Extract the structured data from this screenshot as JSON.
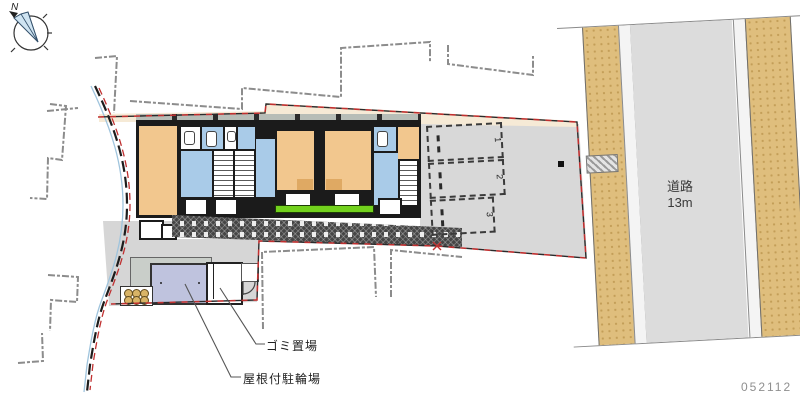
{
  "drawing": {
    "type": "site-and-floor-plan",
    "plan_number": "052112"
  },
  "compass": {
    "north_label": "N"
  },
  "road": {
    "label": "道路",
    "width_label": "13m"
  },
  "annotations": {
    "garbage_label": "ゴミ置場",
    "bike_shed_label": "屋根付駐輪場"
  },
  "parking": {
    "spaces": [
      {
        "label": "1"
      },
      {
        "label": "2"
      },
      {
        "label": "3"
      }
    ]
  },
  "colors": {
    "room_orange": "#f2c78e",
    "wet_area_blue": "#a9cbe8",
    "boundary_red": "#c03030",
    "sidewalk_tan": "#dfbe7d",
    "roadway_gray": "#dcdcdc",
    "paving_gray": "#d8d8d8",
    "setback_cream": "#f6ead6",
    "shed_roof_lavender": "#bfc3de",
    "planting_green": "#72d11d"
  }
}
